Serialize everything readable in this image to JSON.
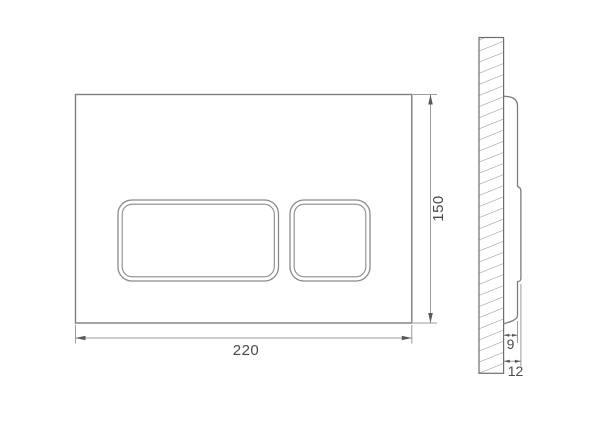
{
  "drawing": {
    "type": "technical-dimension-drawing",
    "subject": "wall-mounted flush plate with two buttons, front view and side section view"
  },
  "dimensions": {
    "plate_width": "220",
    "plate_height": "150",
    "plate_depth": "9",
    "total_depth": "12"
  },
  "colors": {
    "background": "#ffffff",
    "outline": "#7d7d7d",
    "dimension_lines": "#9a9a9a",
    "hatch": "#8a8a8a",
    "text": "#4a4a4a"
  }
}
